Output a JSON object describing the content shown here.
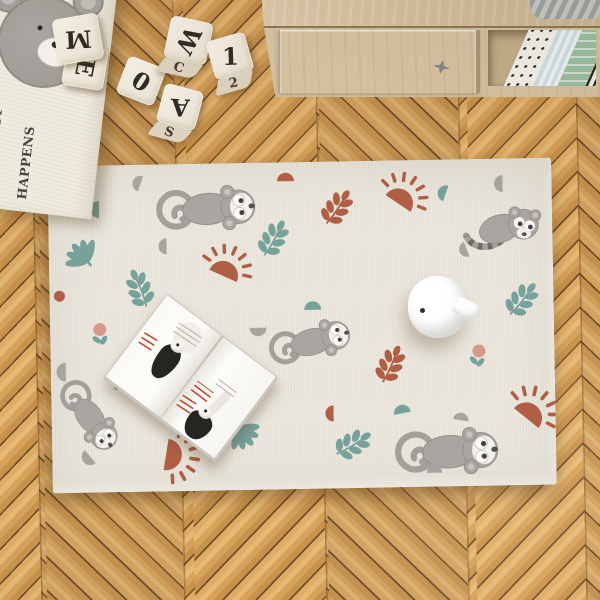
{
  "banner": {
    "lines": [
      "THIS IS WHERE THE",
      "FUN STUFF",
      "HAPPENS"
    ]
  },
  "blocks": {
    "letters": [
      {
        "top": "M"
      },
      {
        "top": "E"
      },
      {
        "top": "0"
      },
      {
        "top": "W",
        "side": "C"
      },
      {
        "top": "1",
        "side": "2"
      },
      {
        "top": "A",
        "side": "S"
      }
    ]
  },
  "rug": {
    "motif_names": [
      "monkey",
      "lemur",
      "half-sun",
      "leaf-sprig",
      "palm-leaf",
      "half-circle",
      "flower"
    ]
  },
  "colors": {
    "rug": "#ebe7de",
    "terracotta": "#b05f44",
    "teal": "#77a29c",
    "gray": "#a8a5a0",
    "pink": "#d59a8c",
    "ink": "#35332f",
    "seam": "#6a4a26",
    "cream": "#f1ece1",
    "oak": "#d8c5a4"
  }
}
